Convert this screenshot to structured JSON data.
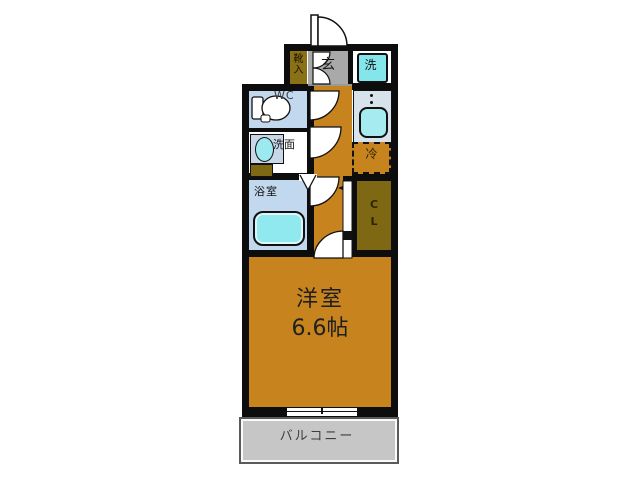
{
  "rooms": {
    "main_room": {
      "name": "洋室",
      "size": "6.6帖"
    },
    "balcony": {
      "name": "バルコニー"
    },
    "bathroom": {
      "name": "浴室"
    },
    "washroom": {
      "name": "洗面"
    },
    "toilet": {
      "name": "WC"
    },
    "entrance": {
      "name": "玄"
    },
    "shoe_cabinet": {
      "char1": "靴",
      "char2": "入"
    },
    "washer": {
      "name": "洗"
    },
    "refrigerator": {
      "name": "冷"
    },
    "closet": {
      "char1": "C",
      "char2": "L"
    }
  },
  "colors": {
    "room_floor": "#C6831E",
    "closet_floor": "#7E6813",
    "entrance_floor": "#A9A9A9",
    "wet_room_blue": "#C2D8EF",
    "fixture_cyan": "#8BE8EC",
    "kitchen_counter": "#D8E2EB",
    "balcony_gray": "#C6C6C6",
    "wall_black": "#0D0D0D"
  }
}
